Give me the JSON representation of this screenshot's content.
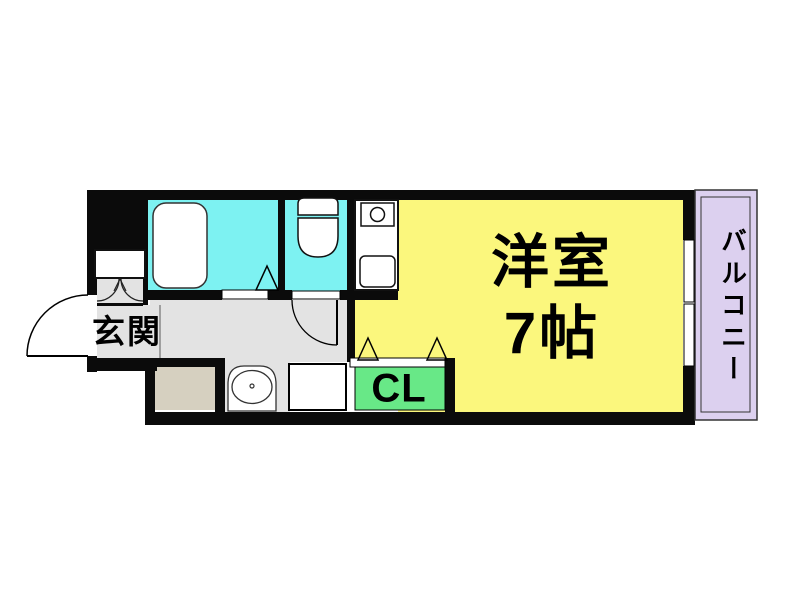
{
  "floorplan": {
    "rooms": {
      "genkan": {
        "label": "玄関"
      },
      "western_room": {
        "label": "洋室",
        "size": "7帖"
      },
      "closet": {
        "label": "CL"
      },
      "balcony": {
        "label": "バルコニー"
      }
    },
    "colors": {
      "wall": "#0b0b0b",
      "bath_cyan": "#7DF2F2",
      "toilet_cyan": "#7DF2F2",
      "room_yellow": "#FBF77D",
      "closet_green": "#68E887",
      "balcony_lavender": "#DCD0EF",
      "floor_gray": "#E3E3E3",
      "laundry_beige": "#D6D0C0",
      "fixture_white": "#FFFFFF"
    }
  }
}
